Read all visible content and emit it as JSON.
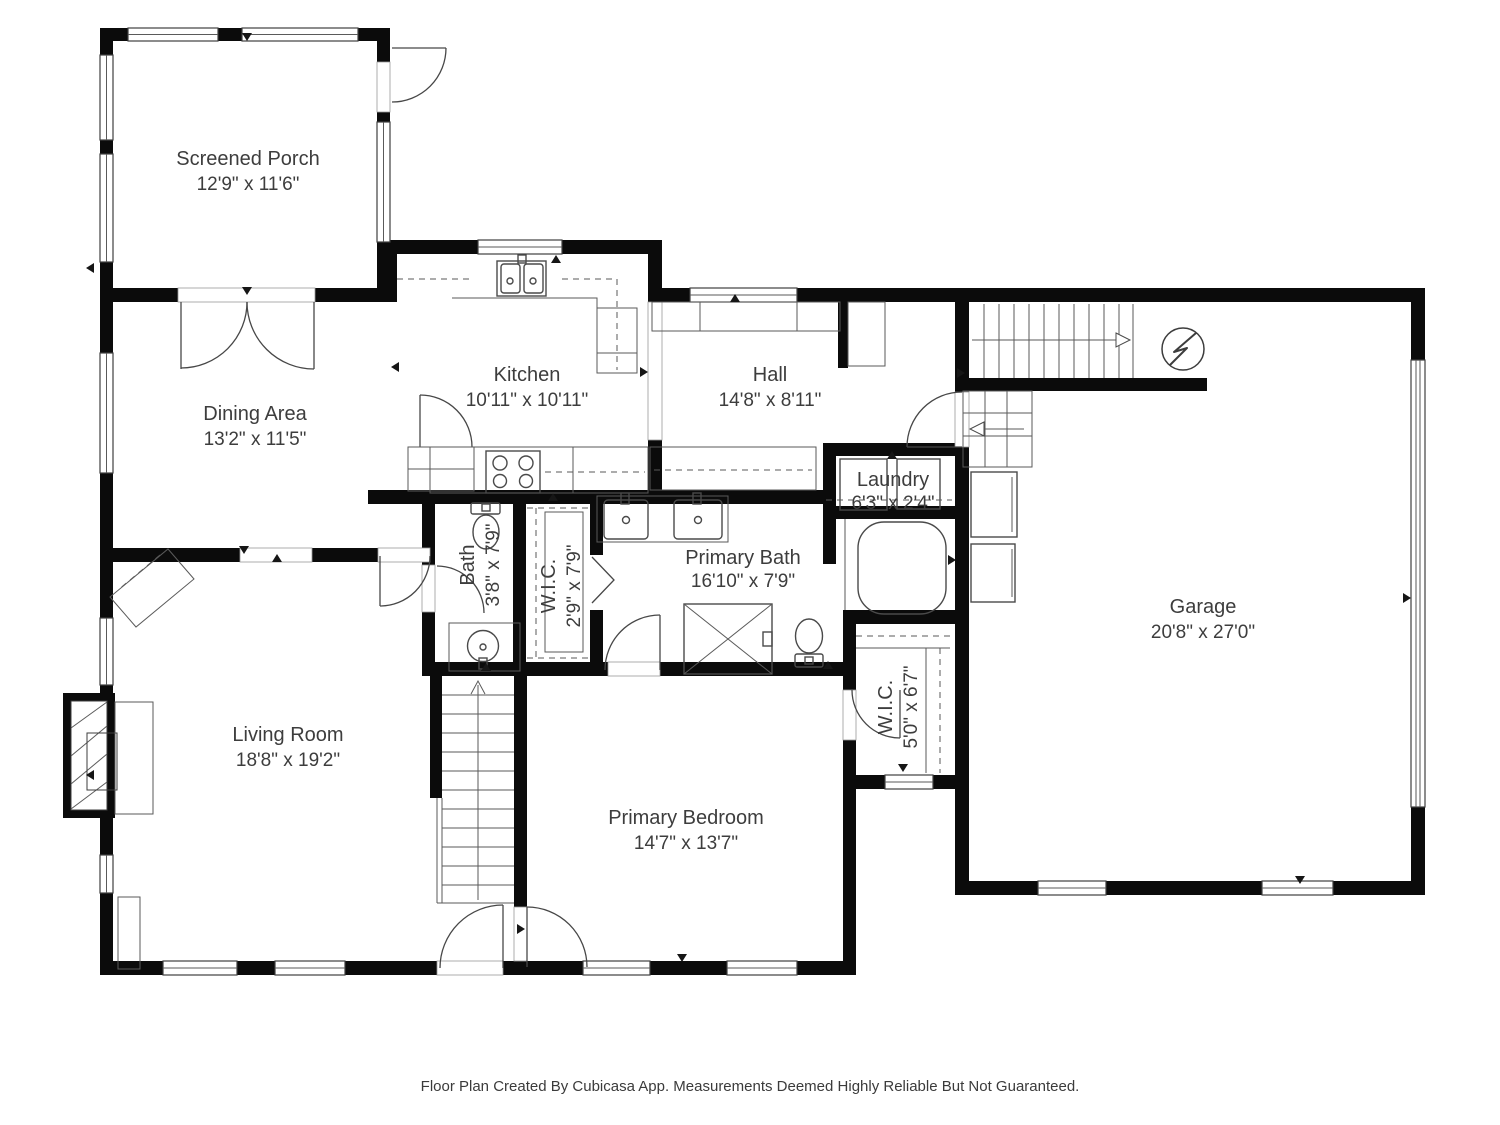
{
  "floorplan": {
    "footer": "Floor Plan Created By Cubicasa App. Measurements Deemed Highly Reliable But Not Guaranteed.",
    "colors": {
      "wall": "#0b0b0b",
      "line": "#4a4a4a",
      "text": "#3d3d3d",
      "background": "#ffffff"
    },
    "rooms": [
      {
        "name": "Screened Porch",
        "dims": "12'9\" x 11'6\""
      },
      {
        "name": "Dining Area",
        "dims": "13'2\" x 11'5\""
      },
      {
        "name": "Kitchen",
        "dims": "10'11\" x 10'11\""
      },
      {
        "name": "Hall",
        "dims": "14'8\" x 8'11\""
      },
      {
        "name": "Laundry",
        "dims": "6'3\" x 2'4\""
      },
      {
        "name": "Primary Bath",
        "dims": "16'10\" x 7'9\""
      },
      {
        "name": "Bath",
        "dims": "3'8\" x 7'9\""
      },
      {
        "name": "W.I.C.",
        "dims": "2'9\" x 7'9\""
      },
      {
        "name": "Garage",
        "dims": "20'8\" x 27'0\""
      },
      {
        "name": "Living Room",
        "dims": "18'8\" x 19'2\""
      },
      {
        "name": "Primary Bedroom",
        "dims": "14'7\" x 13'7\""
      },
      {
        "name": "W.I.C.",
        "dims": "5'0\" x 6'7\""
      }
    ]
  }
}
